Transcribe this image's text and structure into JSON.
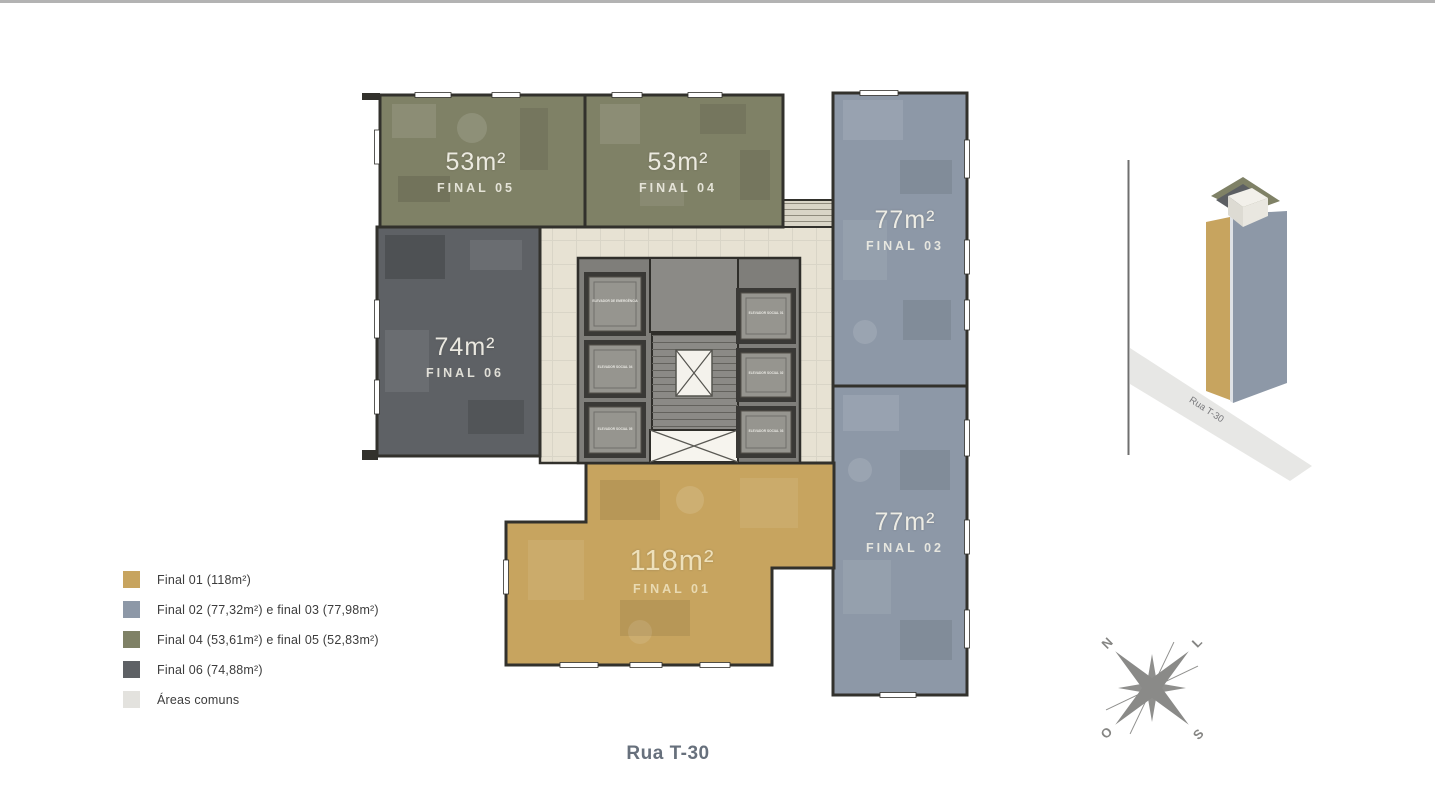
{
  "page": {
    "street_label": "Rua T-30"
  },
  "legend": {
    "items": [
      {
        "label": "Final 01 (118m²)",
        "color": "#c7a45f"
      },
      {
        "label": "Final 02 (77,32m²) e final 03 (77,98m²)",
        "color": "#8d98a7"
      },
      {
        "label": "Final 04 (53,61m²) e final 05 (52,83m²)",
        "color": "#7f8166"
      },
      {
        "label": "Final 06 (74,88m²)",
        "color": "#5e6165"
      },
      {
        "label": "Áreas comuns",
        "color": "#e3e2de"
      }
    ]
  },
  "floorplan": {
    "common_fill": "#e7e2d3",
    "core_fill": "#7f7e7a",
    "wall_color": "#32312c",
    "units": [
      {
        "id": "final05",
        "area": "53m²",
        "name": "FINAL 05"
      },
      {
        "id": "final04",
        "area": "53m²",
        "name": "FINAL 04"
      },
      {
        "id": "final03",
        "area": "77m²",
        "name": "FINAL 03"
      },
      {
        "id": "final06",
        "area": "74m²",
        "name": "FINAL 06"
      },
      {
        "id": "final02",
        "area": "77m²",
        "name": "FINAL 02"
      },
      {
        "id": "final01",
        "area": "118m²",
        "name": "FINAL 01"
      }
    ],
    "core": {
      "elevators_left": [
        {
          "label": "ELEVADOR DE EMERGÊNCIA"
        },
        {
          "label": "ELEVADOR SOCIAL 04"
        },
        {
          "label": "ELEVADOR SOCIAL 05"
        }
      ],
      "elevators_right": [
        {
          "label": "ELEVADOR SOCIAL 01"
        },
        {
          "label": "ELEVADOR SOCIAL 02"
        },
        {
          "label": "ELEVADOR SOCIAL 03"
        }
      ]
    }
  },
  "minimap": {
    "street_label": "Rua T-30"
  },
  "compass": {
    "n": "N",
    "e": "L",
    "s": "S",
    "w": "O"
  }
}
